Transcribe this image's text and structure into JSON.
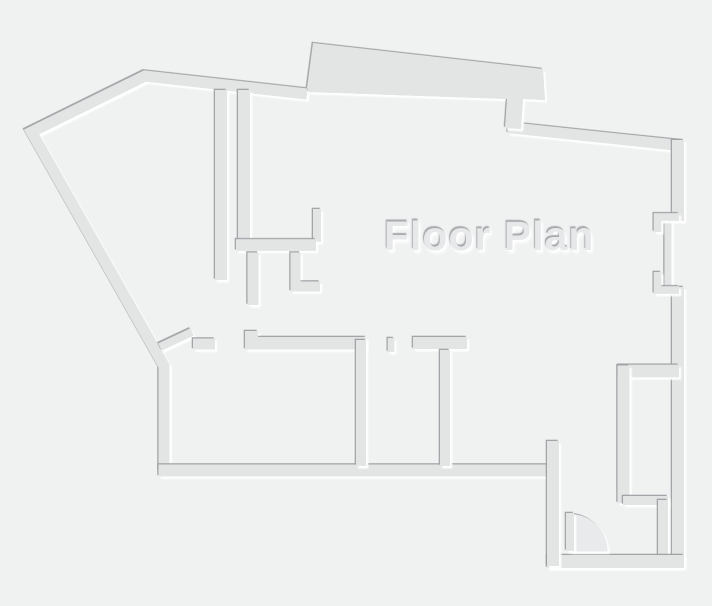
{
  "floorplan": {
    "title": "Floor Plan",
    "type_label": "architectural floor plan drawing",
    "features": {
      "rooms_bottom_row": 4,
      "doors": 3,
      "window_openings_right_wall": 1,
      "door_swing_arc": "bottom-right entry"
    },
    "colors": {
      "background": "#f0f1f1",
      "wall_fill": "#e3e5e5",
      "wall_shadow_edge": "#9a9da0",
      "wall_highlight_edge": "#ffffff",
      "door_swing_fill": "#e9eaeb",
      "title_text": "#e7e8e9"
    }
  }
}
